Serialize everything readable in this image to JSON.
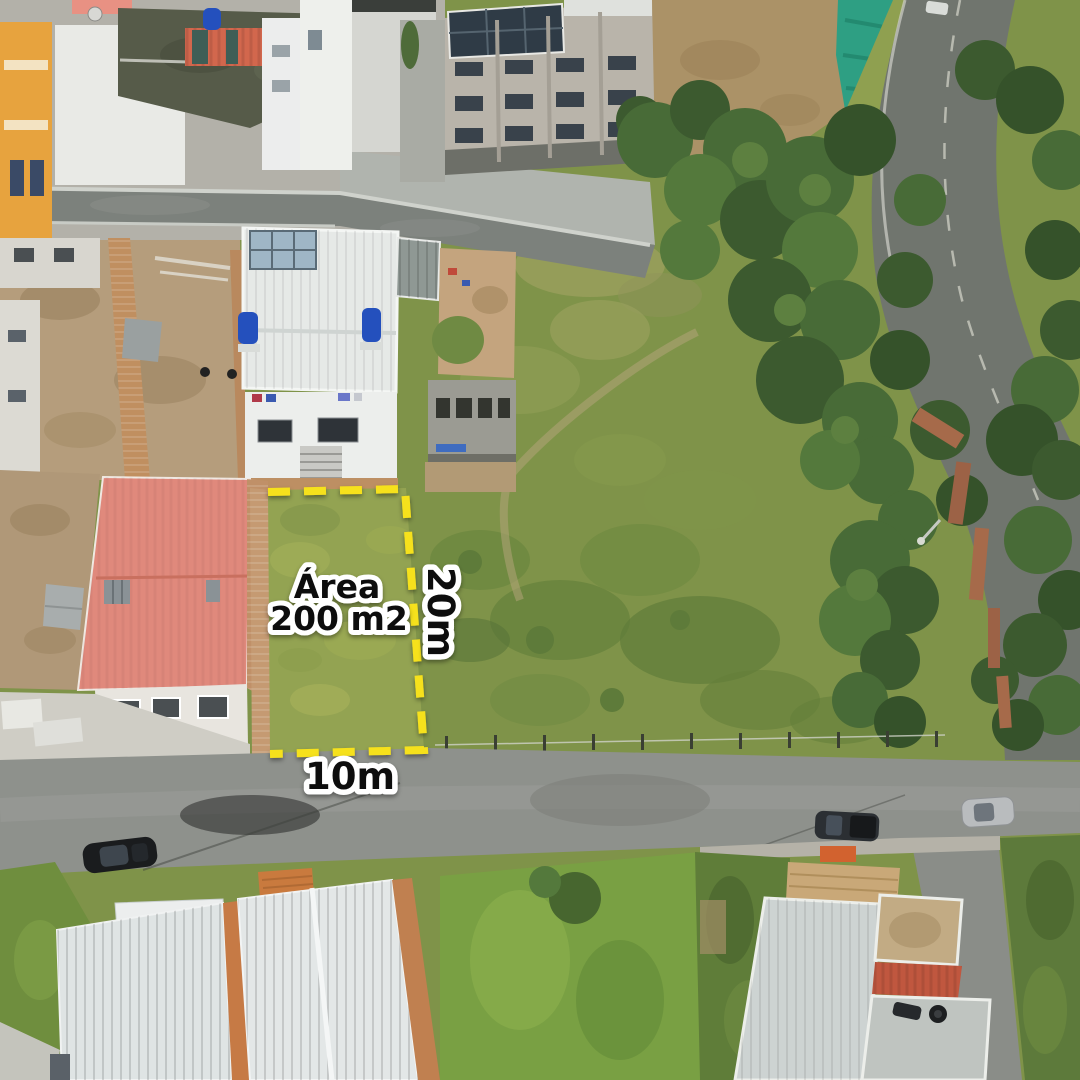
{
  "annotations": {
    "area_line1": "Área",
    "area_line2": "200 m2",
    "side_length": "20m",
    "front_length": "10m"
  },
  "plot": {
    "area_m2": 200,
    "depth_m": 20,
    "front_m": 10
  },
  "style": {
    "outline_color": "#F6E11B",
    "label_fill": "#101010",
    "label_stroke": "#FFFFFF"
  },
  "scene": {
    "description": "Aerial drone photo of a vacant 200 m2 lot marked with a yellow dashed boundary, beside a salmon-red roofed house, fronting a street with parked cars; houses and an apartment block at top-left, eucalyptus trees and a curved road on the right, white-roofed houses below.",
    "palette": {
      "grass_field": "#7f9349",
      "grass_plot": "#93a352",
      "scrub_dark": "#5f7c3a",
      "tree_dark": "#3c5a2f",
      "road_dark": "#7c817c",
      "road_light": "#8e918c",
      "pavement": "#b3b1a9",
      "dirt": "#b39a77",
      "roof_salmon": "#e0897c",
      "roof_tile_red": "#d2674d",
      "roof_white": "#e6e9e7",
      "roof_moss": "#565b49",
      "brick": "#c08f60",
      "orange_building": "#e7a33e",
      "teal_mesh": "#2e9f83",
      "water_tank_blue": "#2450bd"
    }
  }
}
